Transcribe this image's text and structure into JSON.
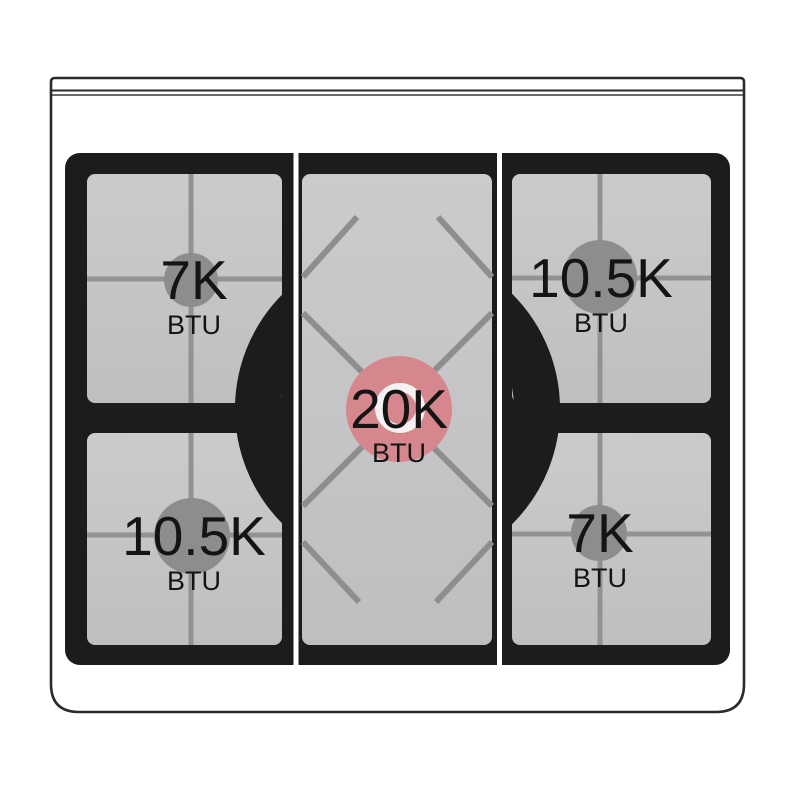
{
  "image_type": "gas-cooktop-burner-power-diagram",
  "burners": {
    "rear_left": {
      "power": "7K",
      "unit": "BTU"
    },
    "rear_right": {
      "power": "10.5K",
      "unit": "BTU"
    },
    "center": {
      "power": "20K",
      "unit": "BTU"
    },
    "front_left": {
      "power": "10.5K",
      "unit": "BTU"
    },
    "front_right": {
      "power": "7K",
      "unit": "BTU"
    }
  },
  "colors": {
    "background": "#ffffff",
    "body_outline": "#2b2b2b",
    "grate_black": "#1c1c1c",
    "panel_gray_top": "#cbcbcd",
    "panel_gray_bottom": "#bfbfc1",
    "grate_line_gray": "#929295",
    "standard_burner_gray": "#8d8d90",
    "center_burner_highlight": "#d5878d",
    "center_burner_cap_ring": "#f3f1f2",
    "label_text": "#141414",
    "separator_white": "#ffffff"
  }
}
